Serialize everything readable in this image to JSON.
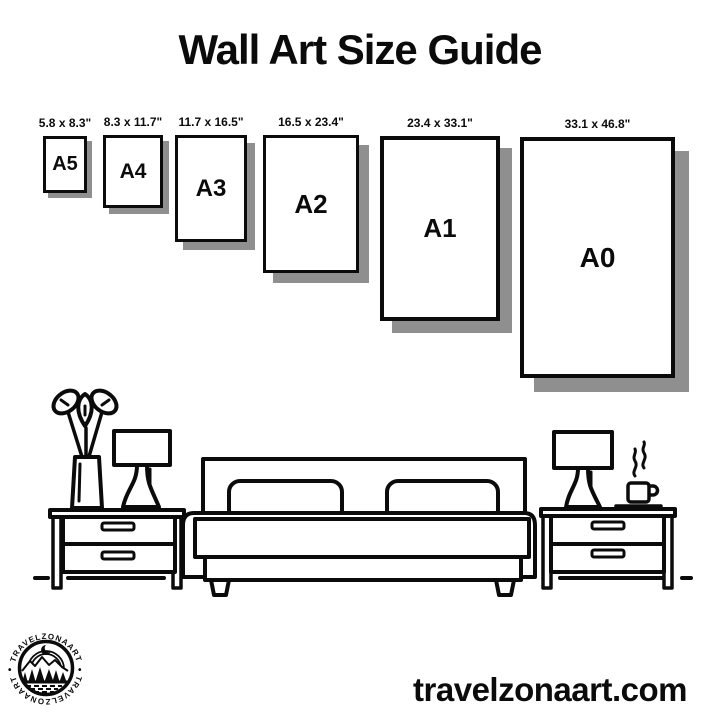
{
  "title": "Wall Art Size Guide",
  "sizes": [
    {
      "name": "A5",
      "dims": "5.8 x 8.3\""
    },
    {
      "name": "A4",
      "dims": "8.3 x 11.7\""
    },
    {
      "name": "A3",
      "dims": "11.7 x 16.5\""
    },
    {
      "name": "A2",
      "dims": "16.5 x 23.4\""
    },
    {
      "name": "A1",
      "dims": "23.4 x 33.1\""
    },
    {
      "name": "A0",
      "dims": "33.1 x 46.8\""
    }
  ],
  "logo": {
    "brand": "TRAVELZONAART",
    "separator": "•"
  },
  "website": "travelzonaart.com",
  "colors": {
    "ink": "#0b0b0b",
    "paper": "#ffffff",
    "shadow": "#8f8f8f"
  }
}
